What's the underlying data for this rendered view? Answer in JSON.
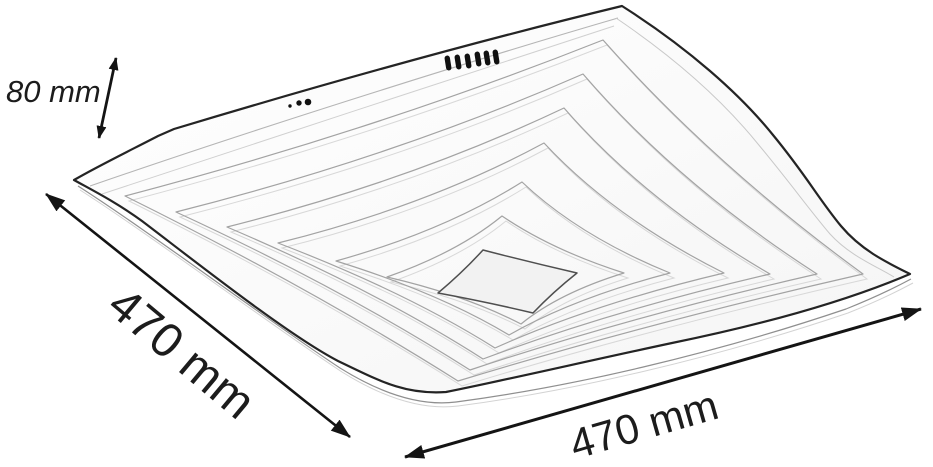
{
  "dimensions": {
    "height": {
      "label": "80 mm"
    },
    "depth": {
      "label": "470 mm"
    },
    "width": {
      "label": "470 mm"
    }
  },
  "icons": {
    "height_arrow": "double-headed-arrow",
    "depth_arrow": "double-headed-arrow",
    "width_arrow": "double-headed-arrow"
  },
  "colors": {
    "background": "#ffffff",
    "outline": "#242424",
    "ring_line": "#a3a3a3",
    "ring_line_faint": "#d8d8d8",
    "rim_line": "#8f8f8f",
    "arrow": "#141414",
    "text": "#1c1c1c",
    "center_panel_fill": "#f2f2f2",
    "pin_color": "#111111"
  },
  "drawing": {
    "subject": "square wave-edge ceiling lamp, perspective line drawing",
    "connector_pins": 6,
    "mounting_dots": 3
  }
}
